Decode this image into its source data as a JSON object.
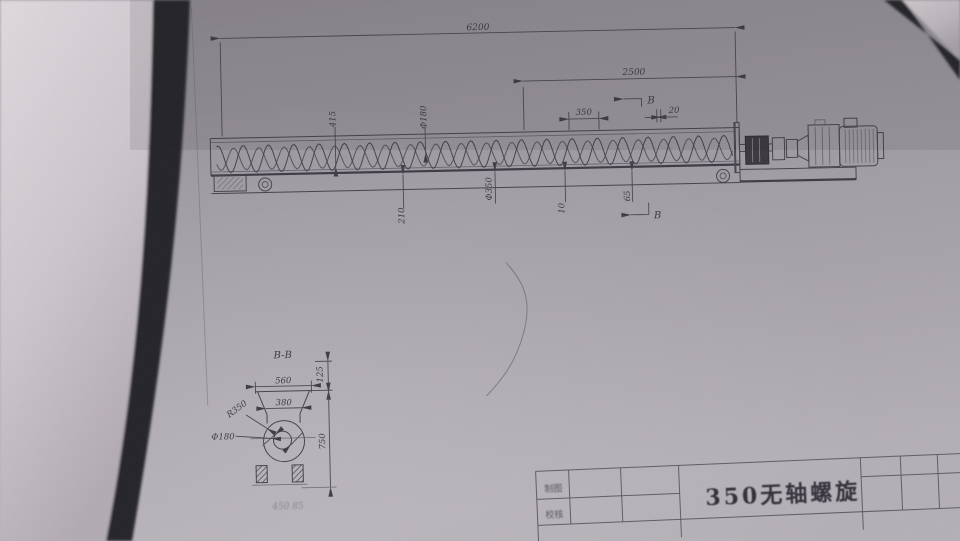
{
  "side_view": {
    "dims": {
      "total_length": "6200",
      "drive_section_length": "2500",
      "pitch": "350",
      "plate_gap": "20",
      "trough_height": "415",
      "spiral_inner_dia": "Φ180",
      "base_height": "210",
      "spiral_outer_dia": "Φ350",
      "gap_ten": "10",
      "gap_sixty_five": "65"
    },
    "section_mark_top": "B",
    "section_mark_bottom": "B"
  },
  "section_view": {
    "label": "B-B",
    "dims": {
      "hopper_top_width": "560",
      "flange_height": "125",
      "hopper_bottom_width": "380",
      "trough_radius": "R350",
      "spiral_inner_dia": "Φ180",
      "overall_height": "750"
    },
    "faint_note": "450 85"
  },
  "title_block": {
    "drafted_label": "制图",
    "checked_label": "校核",
    "drawing_title": "350无轴螺旋"
  },
  "colors": {
    "desk": "#ded8dd",
    "paper": "#a5a1a7",
    "shadow_edge": "#232226",
    "ink": "#45414a"
  }
}
